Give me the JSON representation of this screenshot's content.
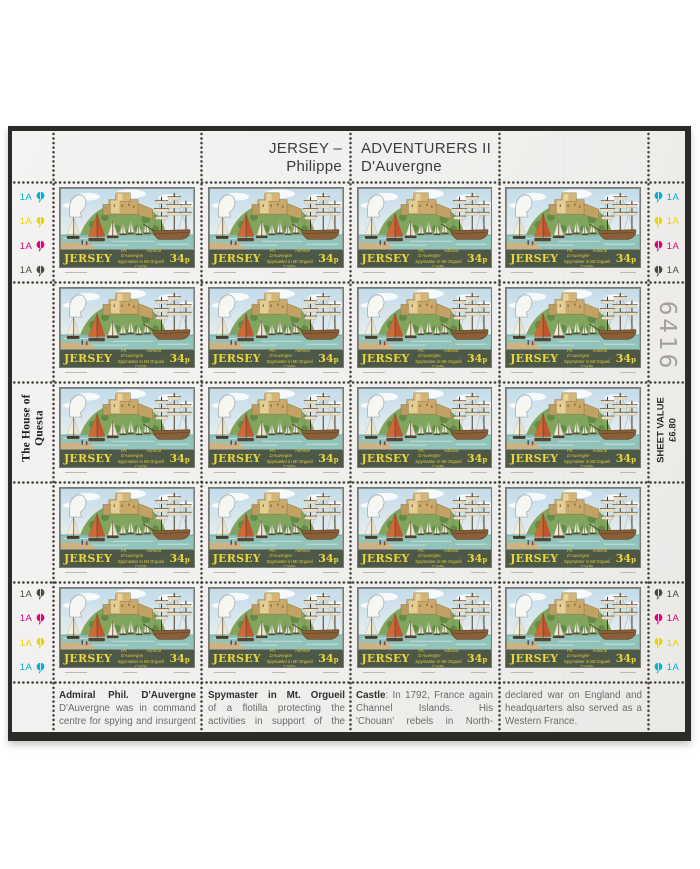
{
  "header": {
    "series_left_line1": "JERSEY –",
    "series_left_line2": "Philippe",
    "series_right_line1": "ADVENTURERS II",
    "series_right_line2": "D'Auvergne"
  },
  "stamp": {
    "country": "JERSEY",
    "denomination": "34p",
    "caption_left": "Ph. D'Auvergne",
    "caption_right": "Admiral",
    "caption_line2": "Spymaster in Mt Orgueil Castle",
    "rows": 5,
    "columns": 4,
    "total": 20,
    "colors": {
      "band": "#4d5847",
      "band_text": "#e8d63e",
      "sky": "#c9dfec",
      "water": "#92c3bb",
      "hill": "#82a55e",
      "castle": "#caa96a",
      "orange_sail": "#cf6a38",
      "ship_hull": "#8a5f38"
    }
  },
  "margin_markers": {
    "top_left": [
      {
        "label": "1A",
        "color": "#00b1d8"
      },
      {
        "label": "1A",
        "color": "#e8d600"
      },
      {
        "label": "1A",
        "color": "#e0017b"
      },
      {
        "label": "1A",
        "color": "#4a4845"
      }
    ],
    "top_right": [
      {
        "label": "1A",
        "color": "#00b1d8"
      },
      {
        "label": "1A",
        "color": "#e8d600"
      },
      {
        "label": "1A",
        "color": "#e0017b"
      },
      {
        "label": "1A",
        "color": "#4a4845"
      }
    ],
    "bottom_left": [
      {
        "label": "1A",
        "color": "#4a4845"
      },
      {
        "label": "1A",
        "color": "#e0017b"
      },
      {
        "label": "1A",
        "color": "#e8d600"
      },
      {
        "label": "1A",
        "color": "#00b1d8"
      }
    ],
    "bottom_right": [
      {
        "label": "1A",
        "color": "#4a4845"
      },
      {
        "label": "1A",
        "color": "#e0017b"
      },
      {
        "label": "1A",
        "color": "#e8d600"
      },
      {
        "label": "1A",
        "color": "#00b1d8"
      }
    ]
  },
  "left_selvedge": {
    "printer_line1": "The House of",
    "printer_line2": "Questa"
  },
  "right_selvedge": {
    "sheet_number": "6416",
    "sheet_value_line1": "SHEET VALUE",
    "sheet_value_line2": "£6.80"
  },
  "footer": {
    "columns": [
      {
        "lines": [
          {
            "justify": true,
            "parts": [
              {
                "text": "Admiral Phil. D'Auvergne",
                "bold": true
              }
            ]
          },
          {
            "justify": true,
            "parts": [
              {
                "text": "D'Auvergne was in command",
                "bold": false
              }
            ]
          },
          {
            "justify": true,
            "parts": [
              {
                "text": "centre for spying and insurgent",
                "bold": false
              }
            ]
          }
        ]
      },
      {
        "lines": [
          {
            "justify": true,
            "parts": [
              {
                "text": "Spymaster in Mt. Orgueil",
                "bold": true
              }
            ]
          },
          {
            "justify": true,
            "parts": [
              {
                "text": "of a flotilla protecting the",
                "bold": false
              }
            ]
          },
          {
            "justify": true,
            "parts": [
              {
                "text": "activities in support of the",
                "bold": false
              }
            ]
          }
        ]
      },
      {
        "lines": [
          {
            "justify": true,
            "parts": [
              {
                "text": "Castle",
                "bold": true
              },
              {
                "text": ": In 1792, France again",
                "bold": false
              }
            ]
          },
          {
            "justify": true,
            "parts": [
              {
                "text": "Channel Islands. His",
                "bold": false
              }
            ]
          },
          {
            "justify": true,
            "parts": [
              {
                "text": "'Chouan' rebels in North-",
                "bold": false
              }
            ]
          }
        ]
      },
      {
        "lines": [
          {
            "justify": true,
            "parts": [
              {
                "text": "declared war on England and",
                "bold": false
              }
            ]
          },
          {
            "justify": true,
            "parts": [
              {
                "text": "headquarters also served as a",
                "bold": false
              }
            ]
          },
          {
            "justify": false,
            "parts": [
              {
                "text": "Western France.",
                "bold": false
              }
            ]
          }
        ]
      }
    ]
  }
}
